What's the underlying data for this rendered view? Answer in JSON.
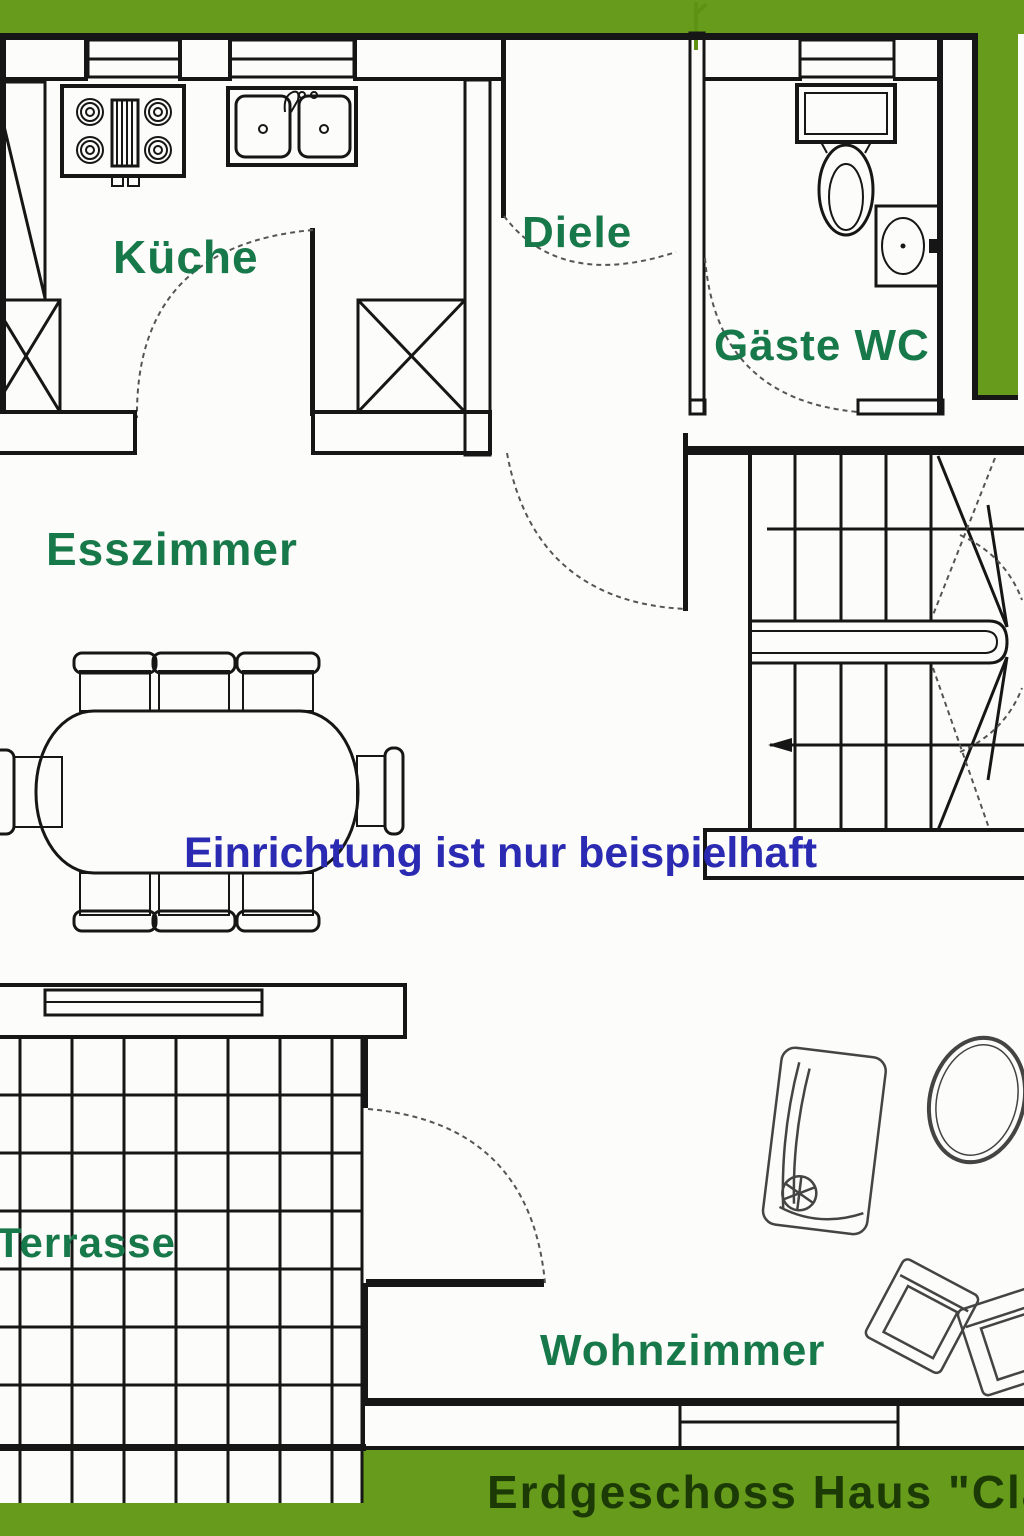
{
  "title_bar": {
    "text": "Erdgeschoss Haus \"Cla"
  },
  "note": {
    "text": "Einrichtung ist nur beispielhaft"
  },
  "rooms": {
    "kueche": {
      "label": "Küche"
    },
    "diele": {
      "label": "Diele"
    },
    "gaestewc": {
      "label": "Gäste WC"
    },
    "esszimmer": {
      "label": "Esszimmer"
    },
    "terrasse": {
      "label": "Terrasse"
    },
    "wohnzimmer": {
      "label": "Wohnzimmer"
    }
  },
  "fixtures": [
    "stove-4-burners",
    "double-sink",
    "tall-cabinet",
    "x-cabinet-left",
    "x-cabinet-right",
    "entry-door",
    "kitchen-door",
    "wc-door",
    "dining-door",
    "terrace-door",
    "toilet",
    "corner-washbasin",
    "u-winder-staircase",
    "stair-direction-arrow",
    "dining-table",
    "dining-chairs-x8",
    "sofa-with-plant",
    "oval-table",
    "armchair-x2",
    "terrace-tile-grid",
    "window-symbols"
  ],
  "colors": {
    "border_green": "#679b1b",
    "label_green": "#17784a",
    "title_green": "#1c3a05",
    "note_blue": "#2a2ab2",
    "wall_black": "#161616",
    "arc_gray": "#555555",
    "paper_white": "#fcfcfa"
  }
}
